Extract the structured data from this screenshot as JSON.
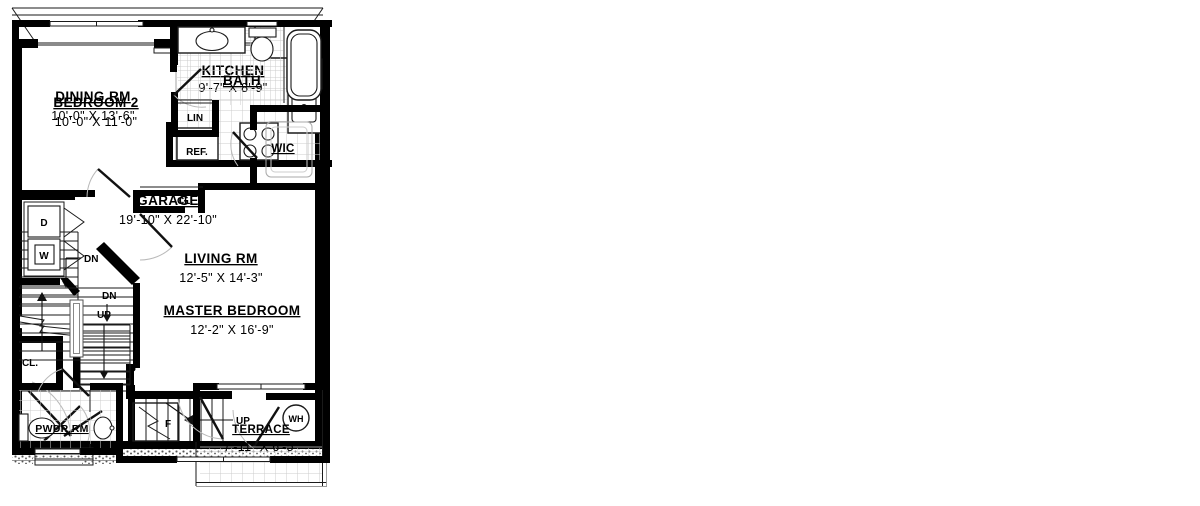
{
  "rooms": {
    "garage": {
      "name": "GARAGE",
      "dim": "19'-10\" X 22'-10\""
    },
    "dining": {
      "name": "DINING RM",
      "dim": "10'-0\" X 13'-6\""
    },
    "kitchen": {
      "name": "KITCHEN",
      "dim": "9'-7\" X 8'-9\""
    },
    "living": {
      "name": "LIVING RM",
      "dim": "12'-5\" X 14'-3\""
    },
    "terrace": {
      "name": "TERRACE",
      "dim": "7'-11\" X 6'-5\""
    },
    "bedroom2": {
      "name": "BEDROOM 2",
      "dim": "10'-0\" X 11'-0\""
    },
    "bath": {
      "name": "BATH"
    },
    "wic": {
      "name": "WIC"
    },
    "master": {
      "name": "MASTER BEDROOM",
      "dim": "12'-2\" X 16'-9\""
    },
    "pwdr": {
      "name": "PWDR RM"
    }
  },
  "labels": {
    "up": "UP",
    "dn": "DN",
    "wh": "WH",
    "dw": "DW",
    "ref": "REF.",
    "cl": "CL.",
    "lin": "LIN",
    "f": "F",
    "d": "D",
    "w": "W"
  },
  "colors": {
    "ink": "#000000",
    "tile_line": "#cccccc",
    "threshold": "#8a8a8a",
    "swing_arc": "#b9b9b9",
    "stipple": "#555555",
    "background": "#ffffff"
  }
}
